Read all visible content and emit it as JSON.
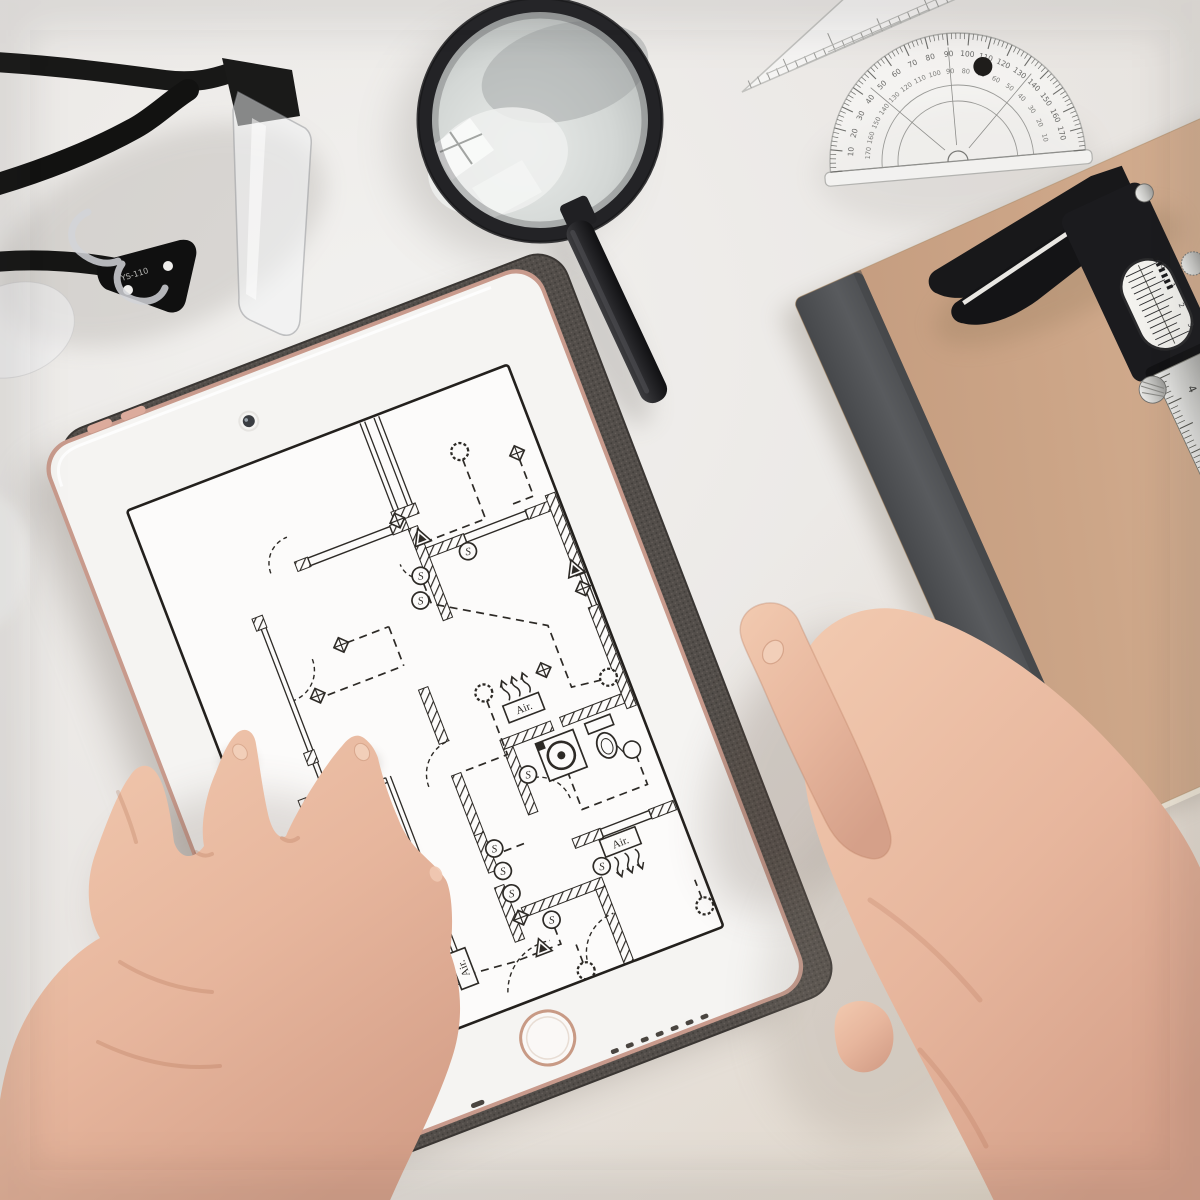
{
  "labels": {
    "air_conditioner": "Air.",
    "switch": "S",
    "glasses_model": "YS-110"
  },
  "colors": {
    "desk_light": "#f2f0ee",
    "desk_mid": "#e9e6e2",
    "desk_warm": "#e3d9c9",
    "ink": "#2d2a26",
    "paper": "#fcfbfa",
    "bezel": "#f4f2f0",
    "rose_gold": "#d5a294",
    "case_fabric": "#514c48",
    "kraft": "#c9a184",
    "kraft_light": "#d7b294",
    "spine": "#55575a",
    "skin_light": "#f3cdb4",
    "skin_mid": "#e6b49c",
    "skin_dark": "#cf9a82",
    "metal_silver": "#d9d9d6",
    "tool_black": "#1b1b1d"
  },
  "protractor": {
    "outer_numbers": [
      10,
      20,
      30,
      40,
      50,
      60,
      70,
      80,
      90,
      100,
      110,
      120,
      130,
      140,
      150,
      160,
      170
    ],
    "inner_numbers": [
      170,
      160,
      150,
      140,
      130,
      120,
      110,
      100,
      90,
      80,
      70,
      60,
      50,
      40,
      30,
      20,
      10
    ]
  },
  "caliper": {
    "beam_numbers": [
      "4",
      "5",
      "6"
    ],
    "dial_numbers": [
      "0",
      "1",
      "2",
      "3"
    ]
  },
  "blueprint": {
    "hatch_walls": [
      [
        246,
        96,
        26,
        11
      ],
      [
        138,
        108,
        14,
        10
      ],
      [
        240,
        108,
        17,
        10
      ],
      [
        256,
        118,
        10,
        98
      ],
      [
        266,
        142,
        40,
        10
      ],
      [
        372,
        142,
        34,
        10
      ],
      [
        208,
        272,
        10,
        58
      ],
      [
        208,
        364,
        10,
        68
      ],
      [
        208,
        428,
        10,
        40
      ],
      [
        208,
        484,
        10,
        58
      ],
      [
        56,
        332,
        16,
        11
      ],
      [
        266,
        348,
        54,
        10
      ],
      [
        330,
        348,
        76,
        10
      ],
      [
        266,
        358,
        10,
        70
      ],
      [
        298,
        466,
        30,
        10
      ],
      [
        380,
        466,
        26,
        10
      ],
      [
        396,
        136,
        10,
        86
      ],
      [
        396,
        256,
        10,
        108
      ],
      [
        226,
        512,
        86,
        10
      ],
      [
        302,
        522,
        10,
        80
      ],
      [
        78,
        146,
        11,
        13
      ],
      [
        78,
        290,
        11,
        13
      ],
      [
        78,
        414,
        11,
        13
      ]
    ],
    "windows": [
      [
        152,
        109,
        88,
        8
      ],
      [
        306,
        143,
        66,
        8
      ],
      [
        328,
        467,
        52,
        8
      ]
    ],
    "thin_pairs": [
      [
        249,
        2,
        249,
        96
      ],
      [
        264,
        2,
        264,
        96
      ],
      [
        83,
        159,
        83,
        290
      ],
      [
        83,
        303,
        83,
        414
      ],
      [
        64,
        342,
        64,
        556
      ],
      [
        64,
        342,
        146,
        342
      ],
      [
        146,
        342,
        146,
        556
      ],
      [
        64,
        556,
        146,
        556
      ],
      [
        400,
        222,
        400,
        256
      ]
    ],
    "lamps": [
      [
        332,
        64
      ],
      [
        390,
        328
      ],
      [
        268,
        298
      ],
      [
        52,
        546
      ],
      [
        264,
        594
      ],
      [
        398,
        576
      ]
    ],
    "switches": [
      [
        251,
        166
      ],
      [
        242,
        189
      ],
      [
        304,
        160
      ],
      [
        222,
        447
      ],
      [
        222,
        471
      ],
      [
        222,
        495
      ],
      [
        280,
        390
      ],
      [
        316,
        502
      ],
      [
        250,
        534
      ]
    ],
    "outlets": [
      [
        249,
        106
      ],
      [
        385,
        86
      ],
      [
        152,
        202
      ],
      [
        112,
        241
      ],
      [
        112,
        372
      ],
      [
        222,
        521
      ],
      [
        96,
        558
      ],
      [
        332,
        298
      ],
      [
        398,
        236
      ]
    ],
    "triangles": [
      [
        265,
        130
      ],
      [
        231,
        556
      ],
      [
        397,
        214
      ]
    ],
    "air_units": [
      [
        300,
        326,
        "up"
      ],
      [
        342,
        486,
        "down"
      ],
      [
        150,
        548,
        "left"
      ]
    ],
    "doors": [
      [
        219,
        366,
        36,
        180,
        270
      ],
      [
        88,
        205,
        32,
        0,
        90
      ],
      [
        88,
        330,
        30,
        0,
        90
      ],
      [
        277,
        428,
        34,
        270,
        360
      ],
      [
        140,
        110,
        28,
        180,
        270
      ],
      [
        310,
        592,
        42,
        180,
        270
      ],
      [
        232,
        604,
        52,
        200,
        280
      ],
      [
        258,
        148,
        22,
        90,
        180
      ]
    ],
    "circuits": [
      [
        [
          332,
          72
        ],
        [
          332,
          136
        ],
        [
          270,
          136
        ]
      ],
      [
        [
          385,
          92
        ],
        [
          385,
          132
        ],
        [
          360,
          132
        ]
      ],
      [
        [
          251,
          174
        ],
        [
          251,
          196
        ],
        [
          352,
          258
        ],
        [
          352,
          324
        ],
        [
          382,
          328
        ]
      ],
      [
        [
          268,
          306
        ],
        [
          268,
          364
        ],
        [
          222,
          364
        ]
      ],
      [
        [
          158,
          202
        ],
        [
          203,
          202
        ]
      ],
      [
        [
          203,
          202
        ],
        [
          203,
          244
        ]
      ],
      [
        [
          197,
          244
        ],
        [
          118,
          244
        ]
      ],
      [
        [
          112,
          378
        ],
        [
          112,
          452
        ]
      ],
      [
        [
          15,
          430
        ],
        [
          15,
          546
        ],
        [
          44,
          546
        ]
      ],
      [
        [
          388,
          410
        ],
        [
          388,
          442
        ],
        [
          318,
          442
        ],
        [
          318,
          400
        ]
      ],
      [
        [
          250,
          542
        ],
        [
          250,
          560
        ],
        [
          200,
          560
        ],
        [
          160,
          556
        ]
      ],
      [
        [
          96,
          564
        ],
        [
          96,
          592
        ]
      ],
      [
        [
          264,
          586
        ],
        [
          264,
          566
        ]
      ],
      [
        [
          398,
          568
        ],
        [
          398,
          548
        ]
      ],
      [
        [
          230,
          453
        ],
        [
          256,
          453
        ]
      ]
    ],
    "washer": {
      "box": [
        298,
        364,
        40,
        40
      ],
      "drum": [
        318,
        384,
        13.5
      ],
      "dot": 4
    },
    "toilet": {
      "tank": [
        351,
        363,
        27,
        11
      ],
      "bowl": [
        364,
        391,
        9.5,
        13
      ],
      "flush": [
        386,
        404,
        8.5
      ]
    }
  }
}
